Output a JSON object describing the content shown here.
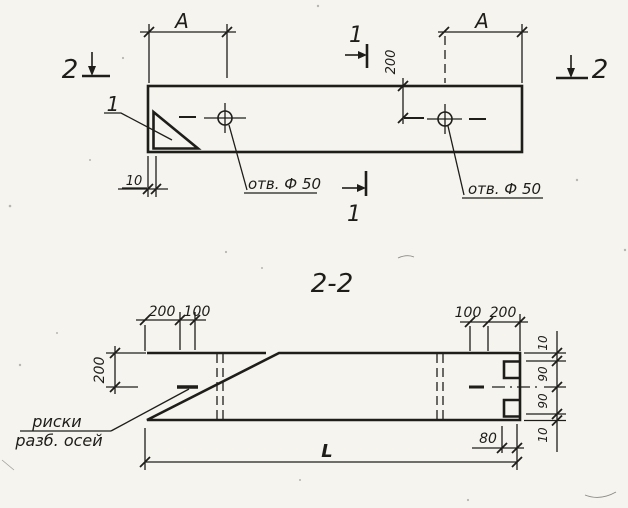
{
  "colors": {
    "ink": "#1f1d1a",
    "paper": "#f5f4ef"
  },
  "top_view": {
    "dim_a_left": "A",
    "dim_a_right": "A",
    "dim_200": "200",
    "dim_10": "10",
    "hole_label_left": "отв. Ф 50",
    "hole_label_right": "отв. Ф 50",
    "section_1_top": "1",
    "section_1_bottom": "1",
    "section_2_left": "2",
    "section_2_right": "2",
    "detail_label": "1"
  },
  "section_view": {
    "title": "2-2",
    "dims_top_left": {
      "d200": "200",
      "d100": "100"
    },
    "dims_top_right": {
      "d100": "100",
      "d200": "200"
    },
    "dim_height": "200",
    "dims_right": {
      "d10_top": "10",
      "d90_upper": "90",
      "d90_lower": "90",
      "d10_bottom": "10"
    },
    "dim_80": "80",
    "dim_length": "L",
    "note": {
      "line1": "риски",
      "line2": "разб. осей"
    }
  }
}
